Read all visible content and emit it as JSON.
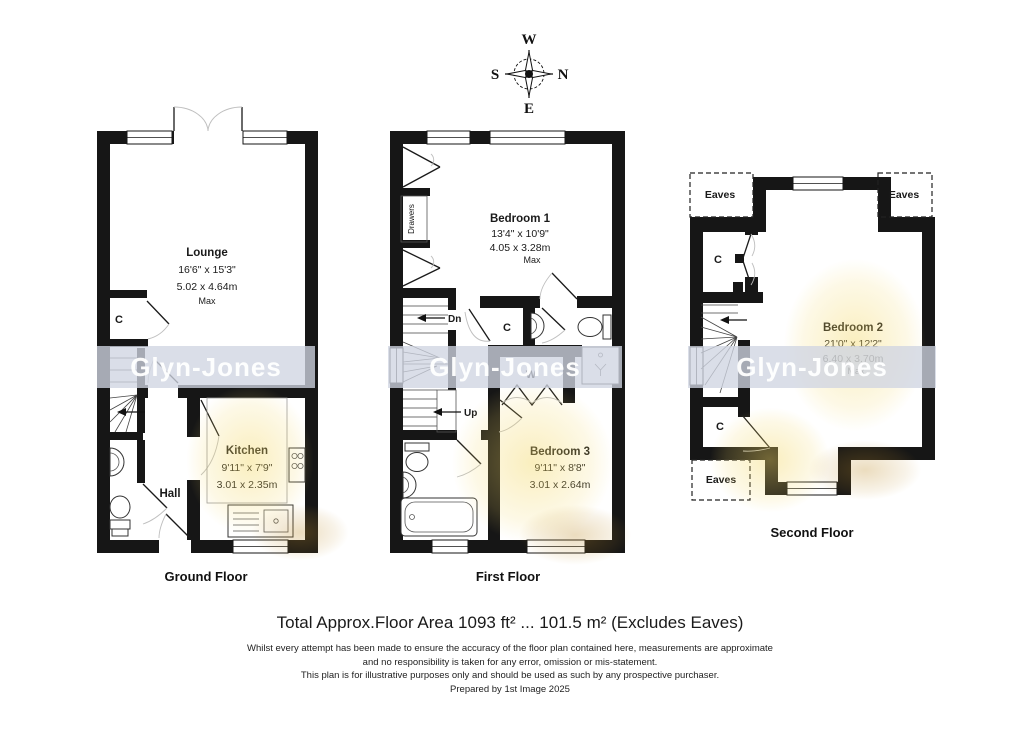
{
  "compass": {
    "top": "W",
    "right": "N",
    "bottom": "E",
    "left": "S"
  },
  "watermark": {
    "text": "Glyn-Jones"
  },
  "floors": {
    "ground": {
      "label": "Ground Floor",
      "lounge_name": "Lounge",
      "lounge_imperial": "16'6\" x 15'3\"",
      "lounge_metric": "5.02 x 4.64m",
      "lounge_max": "Max",
      "kitchen_name": "Kitchen",
      "kitchen_imperial": "9'11\" x 7'9\"",
      "kitchen_metric": "3.01 x 2.35m",
      "hall": "Hall",
      "cupboard": "C"
    },
    "first": {
      "label": "First Floor",
      "bedroom1_name": "Bedroom 1",
      "bedroom1_imperial": "13'4\" x 10'9\"",
      "bedroom1_metric": "4.05 x 3.28m",
      "bedroom1_max": "Max",
      "bedroom3_name": "Bedroom 3",
      "bedroom3_imperial": "9'11\" x 8'8\"",
      "bedroom3_metric": "3.01 x 2.64m",
      "wardrobe": "W",
      "cupboard": "C",
      "drawers": "Drawers",
      "down_label": "Dn",
      "up_label": "Up"
    },
    "second": {
      "label": "Second Floor",
      "bedroom2_name": "Bedroom 2",
      "bedroom2_imperial": "21'0\" x 12'2\"",
      "bedroom2_metric": "6.40 x 3.70m",
      "bedroom2_max": "Max",
      "cupboard_upper": "C",
      "cupboard_lower": "C",
      "eaves_top_left": "Eaves",
      "eaves_top_right": "Eaves",
      "eaves_bottom_left": "Eaves"
    }
  },
  "footer": {
    "total_area": "Total Approx.Floor Area 1093 ft² ... 101.5 m² (Excludes Eaves)",
    "disclaimer1": "Whilst every attempt has been made to ensure the accuracy of the floor plan contained here, measurements are approximate",
    "disclaimer2": "and no responsibility is taken for any error, omission or mis-statement.",
    "disclaimer3": "This plan is for illustrative purposes only and should be used as such by any prospective purchaser.",
    "prepared_by": "Prepared by 1st Image 2025"
  }
}
